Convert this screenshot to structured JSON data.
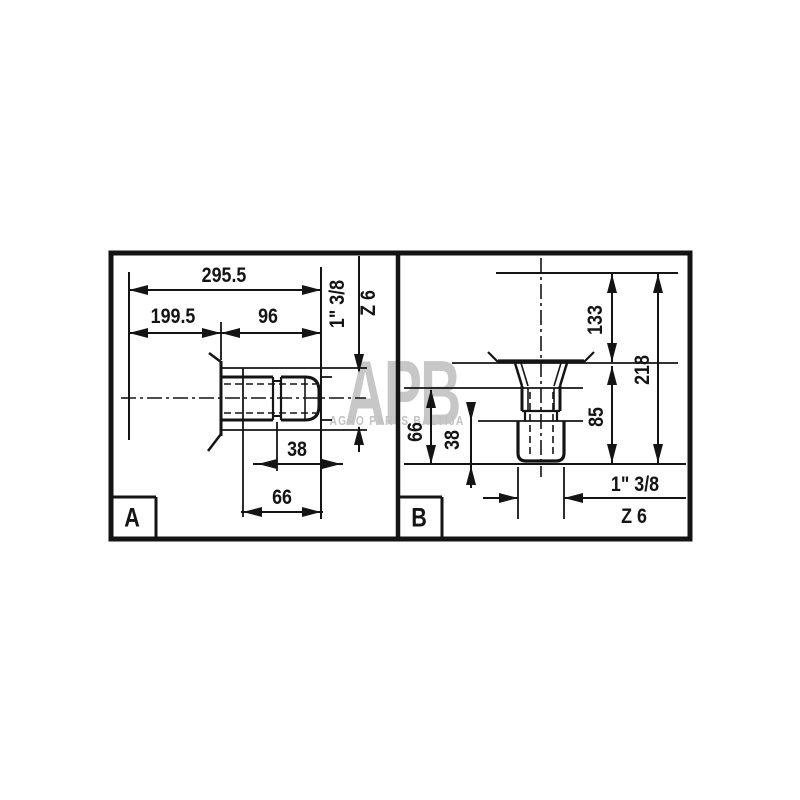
{
  "watermark": {
    "logo": "APB",
    "subtitle": "AGRO PARTS BALTIJA"
  },
  "panel_a": {
    "label": "A",
    "dim_total_length": "295.5",
    "dim_left_length": "199.5",
    "dim_right_length": "96",
    "dim_spline_length": "38",
    "dim_end_length": "66",
    "spline_size": "1\" 3/8",
    "spline_teeth": "Z 6"
  },
  "panel_b": {
    "label": "B",
    "dim_upper_length": "133",
    "dim_total_length": "218",
    "dim_lower_length": "85",
    "dim_side_length": "66",
    "dim_spline_length": "38",
    "spline_size": "1\" 3/8",
    "spline_teeth": "Z 6"
  },
  "colors": {
    "line": "#141414",
    "watermark": "#c7c7c7",
    "background": "#ffffff"
  }
}
